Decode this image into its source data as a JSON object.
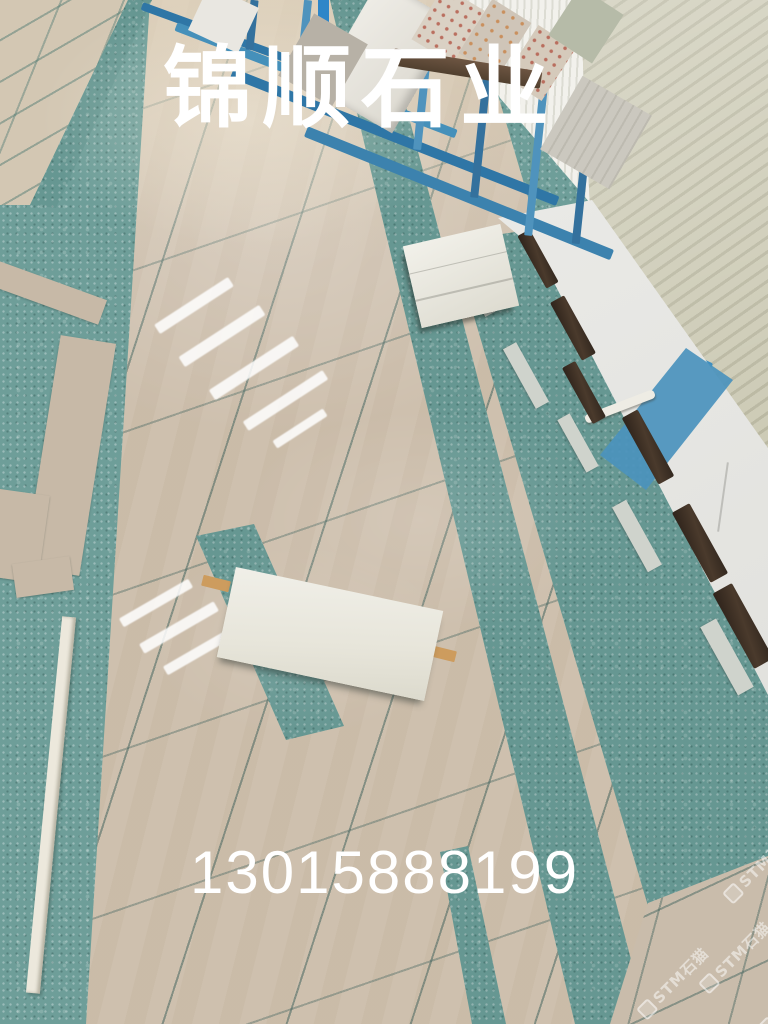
{
  "overlay": {
    "title": "锦顺石业",
    "phone": "13015888199"
  },
  "watermark": {
    "brand": "STM石猫"
  },
  "scene": {
    "type": "photo",
    "subject": "Stone factory showroom floor: polished beige marble tile field laid on teal terrazzo with inlaid white slabs, slab racks and warehouse wall in background",
    "colors": {
      "teal_floor": "#6E9E99",
      "tile_beige": "#CEC0AE",
      "tile_beige_far": "#D3C7B3",
      "grout": "#466660",
      "white_slab": "#EBE9DE",
      "wood_stick": "#CD9C5E",
      "dark_wood": "#382C22",
      "rack_steel_blue": "#2F76A6",
      "wall_white": "#ECECEA",
      "wall_blue_stripe": "#4B92BD",
      "corrugated_panel": "#C9C7B2"
    }
  }
}
